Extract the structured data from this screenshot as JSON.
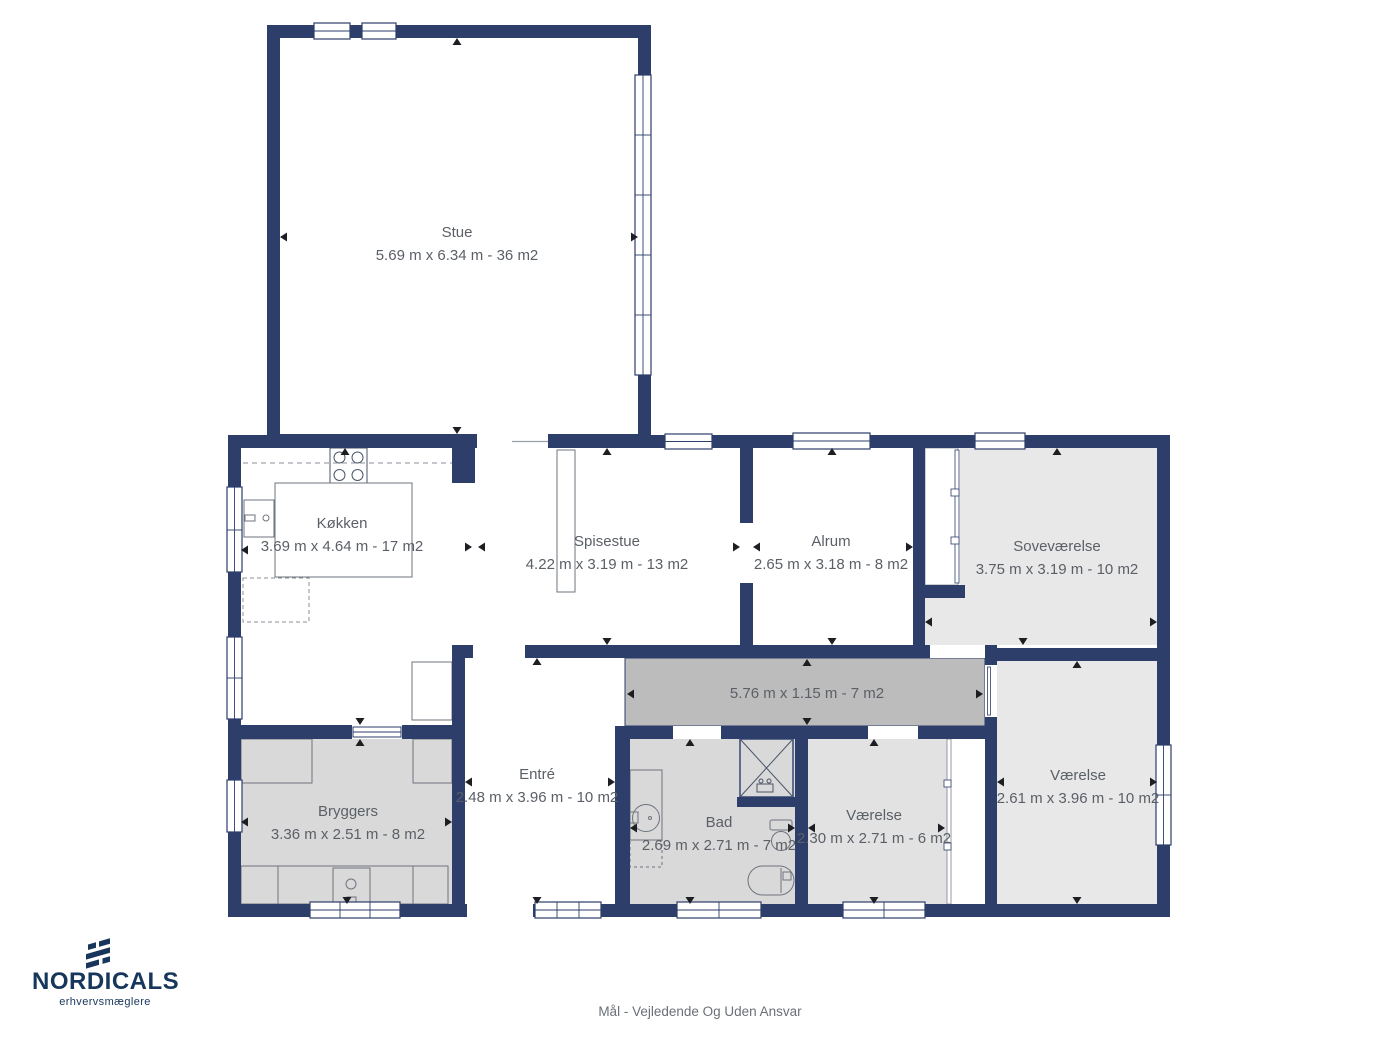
{
  "plan": {
    "rooms": [
      {
        "name": "Stue",
        "dims": "5.69 m x 6.34 m - 36 m2"
      },
      {
        "name": "Køkken",
        "dims": "3.69 m x 4.64 m - 17 m2"
      },
      {
        "name": "Spisestue",
        "dims": "4.22 m x 3.19 m - 13 m2"
      },
      {
        "name": "Alrum",
        "dims": "2.65 m x 3.18 m - 8 m2"
      },
      {
        "name": "Soveværelse",
        "dims": "3.75 m x 3.19 m - 10 m2"
      },
      {
        "name": "",
        "dims": "5.76 m x 1.15 m - 7 m2"
      },
      {
        "name": "Entré",
        "dims": "2.48 m x 3.96 m - 10 m2"
      },
      {
        "name": "Bryggers",
        "dims": "3.36 m x 2.51 m - 8 m2"
      },
      {
        "name": "Bad",
        "dims": "2.69 m x 2.71 m - 7 m2"
      },
      {
        "name": "Værelse",
        "dims": "2.30 m x 2.71 m - 6 m2"
      },
      {
        "name": "Værelse",
        "dims": "2.61 m x 3.96 m - 10 m2"
      }
    ]
  },
  "branding": {
    "logo_text": "NORDICALS",
    "logo_subtext": "erhvervsmæglere"
  },
  "footer": {
    "disclaimer": "Mål - Vejledende Og Uden Ansvar"
  },
  "colors": {
    "wall": "#2d3e6b",
    "room_light": "#e8e8e8",
    "room_mid": "#d9d9d9",
    "corridor": "#bcbcbc",
    "label_text": "#5b6067",
    "logo_navy": "#17365c"
  }
}
